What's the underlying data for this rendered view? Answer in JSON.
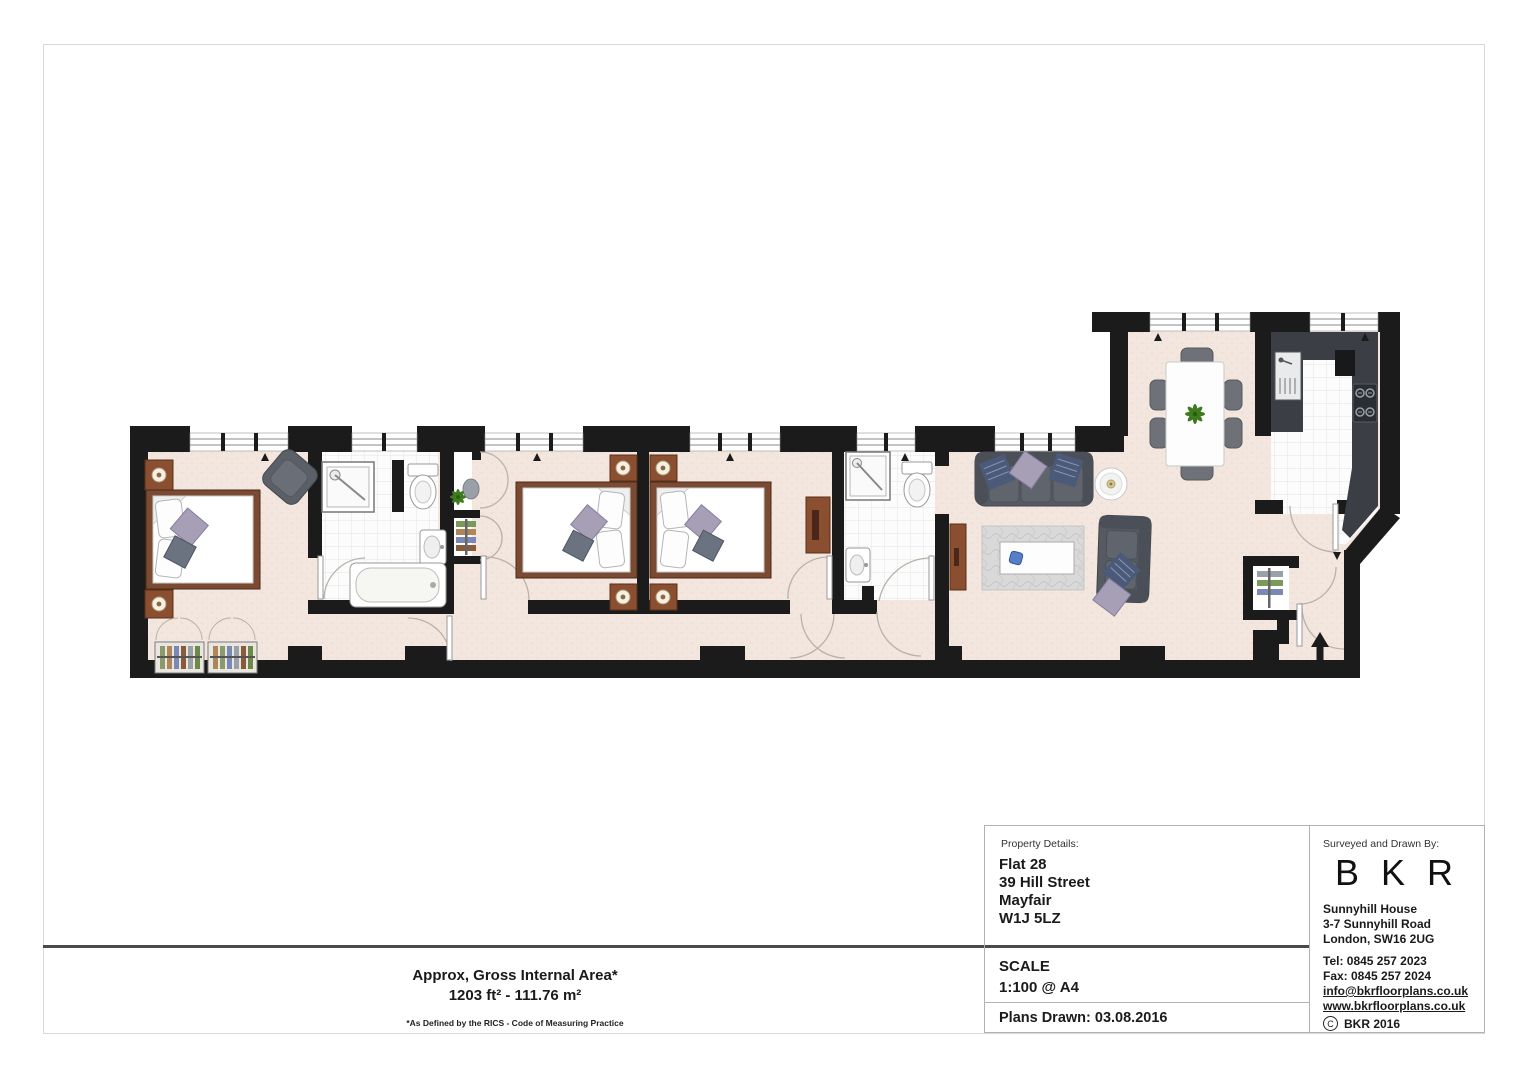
{
  "area_note": {
    "line1": "Approx, Gross Internal Area*",
    "line2": "1203 ft² - 111.76 m²",
    "footnote": "*As Defined by the RICS - Code of Measuring Practice"
  },
  "title_block": {
    "property": {
      "label": "Property Details:",
      "line1": "Flat 28",
      "line2": "39 Hill Street",
      "line3": "Mayfair",
      "line4": "W1J 5LZ"
    },
    "scale_label": "SCALE",
    "scale_value": "1:100 @ A4",
    "plans_drawn": "Plans Drawn: 03.08.2016",
    "surveyor": {
      "label": "Surveyed and Drawn By:",
      "logo": "B K R",
      "addr1": "Sunnyhill House",
      "addr2": "3-7 Sunnyhill Road",
      "addr3": "London, SW16 2UG",
      "tel": "Tel: 0845 257 2023",
      "fax": "Fax: 0845 257 2024",
      "email": "info@bkrfloorplans.co.uk",
      "website": "www.bkrfloorplans.co.uk",
      "copyright_symbol": "C",
      "copyright": "BKR 2016"
    }
  },
  "floorplan": {
    "colors": {
      "wall": "#1b1b1b",
      "floor": "#f3e6de",
      "tile": "#fcfcfc",
      "wood": "#8a4e30",
      "bed_frame": "#7b4a33",
      "sofa": "#565a62",
      "pillow_lavender": "#a79fb5",
      "pillow_navy": "#4a5a78",
      "rug": "#d9d9d9",
      "counter": "#3b3f45",
      "plant": "#3e7a1e"
    },
    "rooms": [
      {
        "name": "bedroom-1",
        "furniture": [
          "double-bed",
          "bedside-tables",
          "armchair",
          "fitted-wardrobes"
        ]
      },
      {
        "name": "ensuite-bathroom",
        "furniture": [
          "shower",
          "toilet",
          "basin",
          "bathtub"
        ]
      },
      {
        "name": "dressing-closet",
        "furniture": [
          "shelf",
          "plant",
          "hanging-rail"
        ]
      },
      {
        "name": "bedroom-2",
        "furniture": [
          "double-bed",
          "bedside-tables"
        ]
      },
      {
        "name": "bedroom-3",
        "furniture": [
          "double-bed",
          "bedside-tables",
          "cabinet"
        ]
      },
      {
        "name": "shower-room",
        "furniture": [
          "shower",
          "toilet",
          "basin"
        ]
      },
      {
        "name": "hallway",
        "furniture": [
          "double-doors"
        ]
      },
      {
        "name": "reception-room",
        "furniture": [
          "sofa-3-seat",
          "sofa-2-seat",
          "coffee-table",
          "rug",
          "round-side-table",
          "console"
        ]
      },
      {
        "name": "dining-area",
        "furniture": [
          "dining-table",
          "six-chairs",
          "plant"
        ]
      },
      {
        "name": "kitchen",
        "furniture": [
          "sink-unit",
          "hob",
          "worktops"
        ]
      },
      {
        "name": "entrance",
        "furniture": [
          "coat-cupboard",
          "entry-arrow"
        ]
      }
    ]
  }
}
